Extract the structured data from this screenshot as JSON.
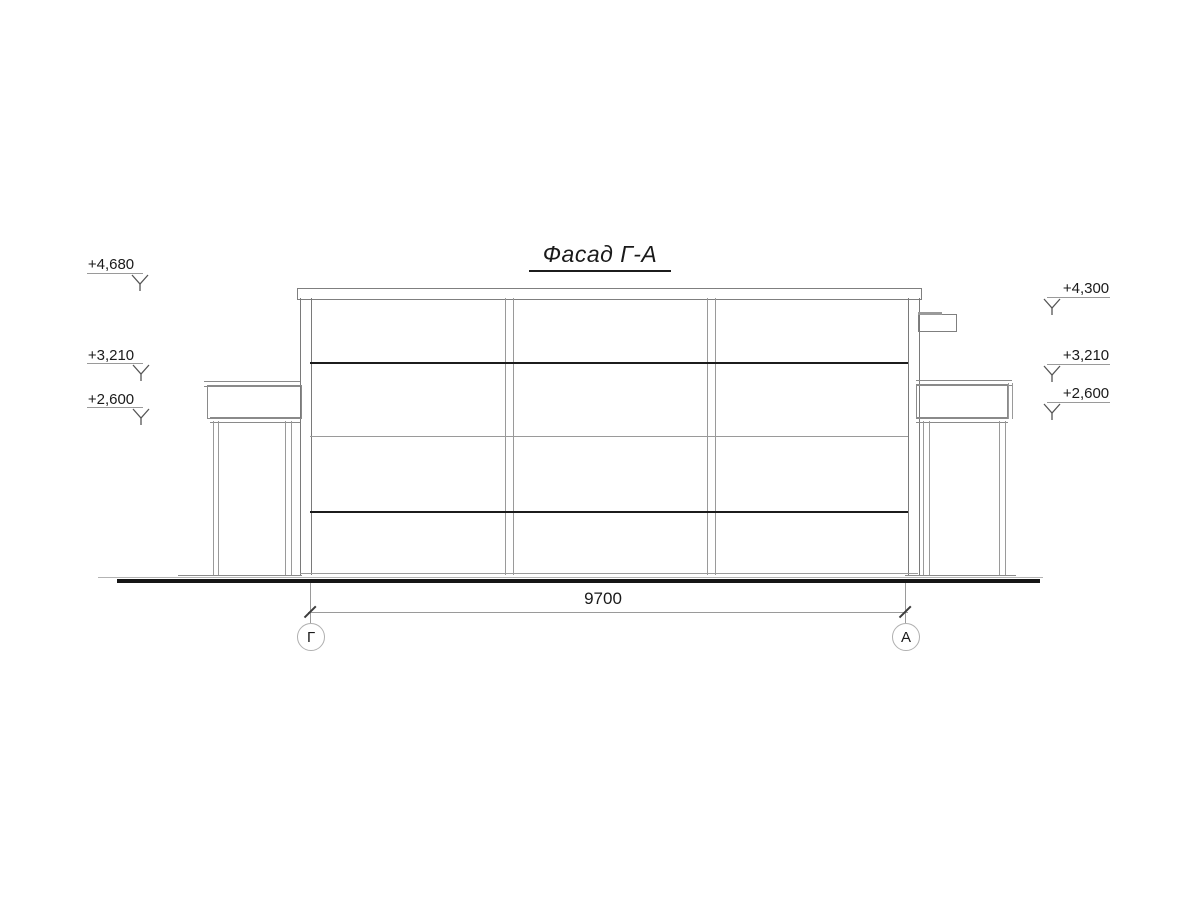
{
  "drawing": {
    "title": "Фасад Г-А",
    "dimension": {
      "value": "9700"
    },
    "axes": {
      "left": "Г",
      "right": "А"
    },
    "elevations_left": [
      {
        "value": "+4,680"
      },
      {
        "value": "+3,210"
      },
      {
        "value": "+2,600"
      }
    ],
    "elevations_right": [
      {
        "value": "+4,300"
      },
      {
        "value": "+3,210"
      },
      {
        "value": "+2,600"
      }
    ],
    "colors": {
      "background": "#ffffff",
      "line_dark": "#1c1c1c",
      "line_medium": "#7f7f7f",
      "line_light": "#9a9a9a",
      "ground": "#161616"
    }
  }
}
